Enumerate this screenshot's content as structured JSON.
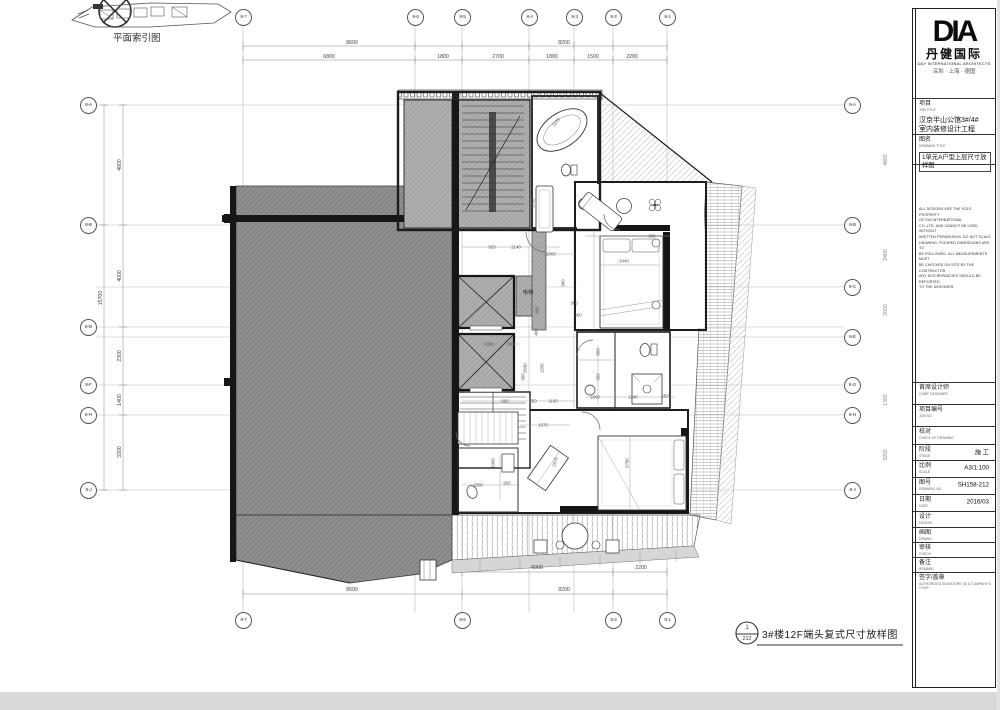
{
  "page": {
    "plan_index_label": "平面索引图"
  },
  "grid": {
    "top": [
      "8-7",
      "8-6",
      "8-5",
      "8-4",
      "8-3",
      "8-2",
      "8-1"
    ],
    "bottom": [
      "8-7",
      "8-5",
      "8-2",
      "8-1"
    ],
    "left": [
      "8-A",
      "8-B",
      "8-D",
      "8-F",
      "8-H",
      "8-J"
    ],
    "right": [
      "8-A",
      "8-B",
      "8-C",
      "8-E",
      "8-G",
      "8-H",
      "8-J"
    ]
  },
  "dims": {
    "top1": [
      "8600",
      "8200"
    ],
    "top2": [
      "6800",
      "1800",
      "2700",
      "1800",
      "1500",
      "2200"
    ],
    "left_overall": "15700",
    "left_segs": [
      "4800",
      "4000",
      "2300",
      "1400",
      "3200"
    ],
    "right_segs": [
      "4800",
      "2400",
      "2000",
      "1300",
      "3200"
    ],
    "bottom1": [
      "6000",
      "2200"
    ],
    "bottom2": [
      "8600",
      "8200"
    ],
    "interior": [
      "920",
      "2140",
      "1000",
      "3440",
      "800",
      "1730",
      "1125",
      "960",
      "360",
      "560",
      "850",
      "400",
      "1090",
      "800",
      "2090",
      "2250",
      "950",
      "850",
      "950",
      "1860",
      "1340",
      "550",
      "600",
      "850",
      "1100",
      "1970",
      "1900",
      "900",
      "1500",
      "2576",
      "5780"
    ]
  },
  "labels": {
    "elevator": "电梯"
  },
  "footer": {
    "detail_no": "1",
    "sheet_no": "212",
    "title": "3#楼12F端头复式尺寸放样图"
  },
  "titleblock": {
    "brand": "DIA",
    "brand_cn": "丹健国际",
    "brand_en": "D&Y INTERNATIONAL ARCHITECTS",
    "cities": "深圳 · 上海 · 德国",
    "job_label": "项目",
    "job_sub": "JOB TITLE",
    "job_line1": "汉京半山公馆3#/4#",
    "job_line2": "室内装修设计工程",
    "name_label": "图名",
    "name_sub": "DRAWING TITLE",
    "name_value": "1单元A户型上层尺寸放样图",
    "disclaimer": [
      "ALL DESIGNS ARE THE SOLE PROPERTY",
      "OF DIA INTERNATIONAL",
      "CO.,LTD. AND CANNOT BE USED WITHOUT",
      "WRITTEN PERMISSION. DO NOT SCALE",
      "DRAWING. FIGURED DIMENSIONS ARE TO",
      "BE FOLLOWED. ALL MEASUREMENTS MUST",
      "BE CHECKED ON SITE BY THE CONTRACTOR.",
      "ANY DISCREPANCIES SHOULD BE REPORTED",
      "TO THE DESIGNER."
    ],
    "fields": [
      {
        "cn": "首席设计师",
        "en": "CHIEF DESIGNER",
        "value": ""
      },
      {
        "cn": "项目编号",
        "en": "JOB NO.",
        "value": ""
      },
      {
        "cn": "校对",
        "en": "CHECK OF DRAWING",
        "value": ""
      },
      {
        "cn": "阶段",
        "en": "STAGE",
        "value": "施 工"
      },
      {
        "cn": "比例",
        "en": "SCALE",
        "value": "A3/1:100"
      },
      {
        "cn": "图号",
        "en": "DRAWING NO.",
        "value": "SH158-212"
      },
      {
        "cn": "日期",
        "en": "DATE",
        "value": "2016/03"
      },
      {
        "cn": "设计",
        "en": "DESIGN",
        "value": ""
      },
      {
        "cn": "画图",
        "en": "DRAWN",
        "value": ""
      },
      {
        "cn": "审核",
        "en": "CHECK",
        "value": ""
      },
      {
        "cn": "备注",
        "en": "REMARK",
        "value": ""
      },
      {
        "cn": "签字/盖章",
        "en": "AUTHORIZED SIGNATURE (S) & COMPANY'S CHOP",
        "value": ""
      }
    ]
  }
}
